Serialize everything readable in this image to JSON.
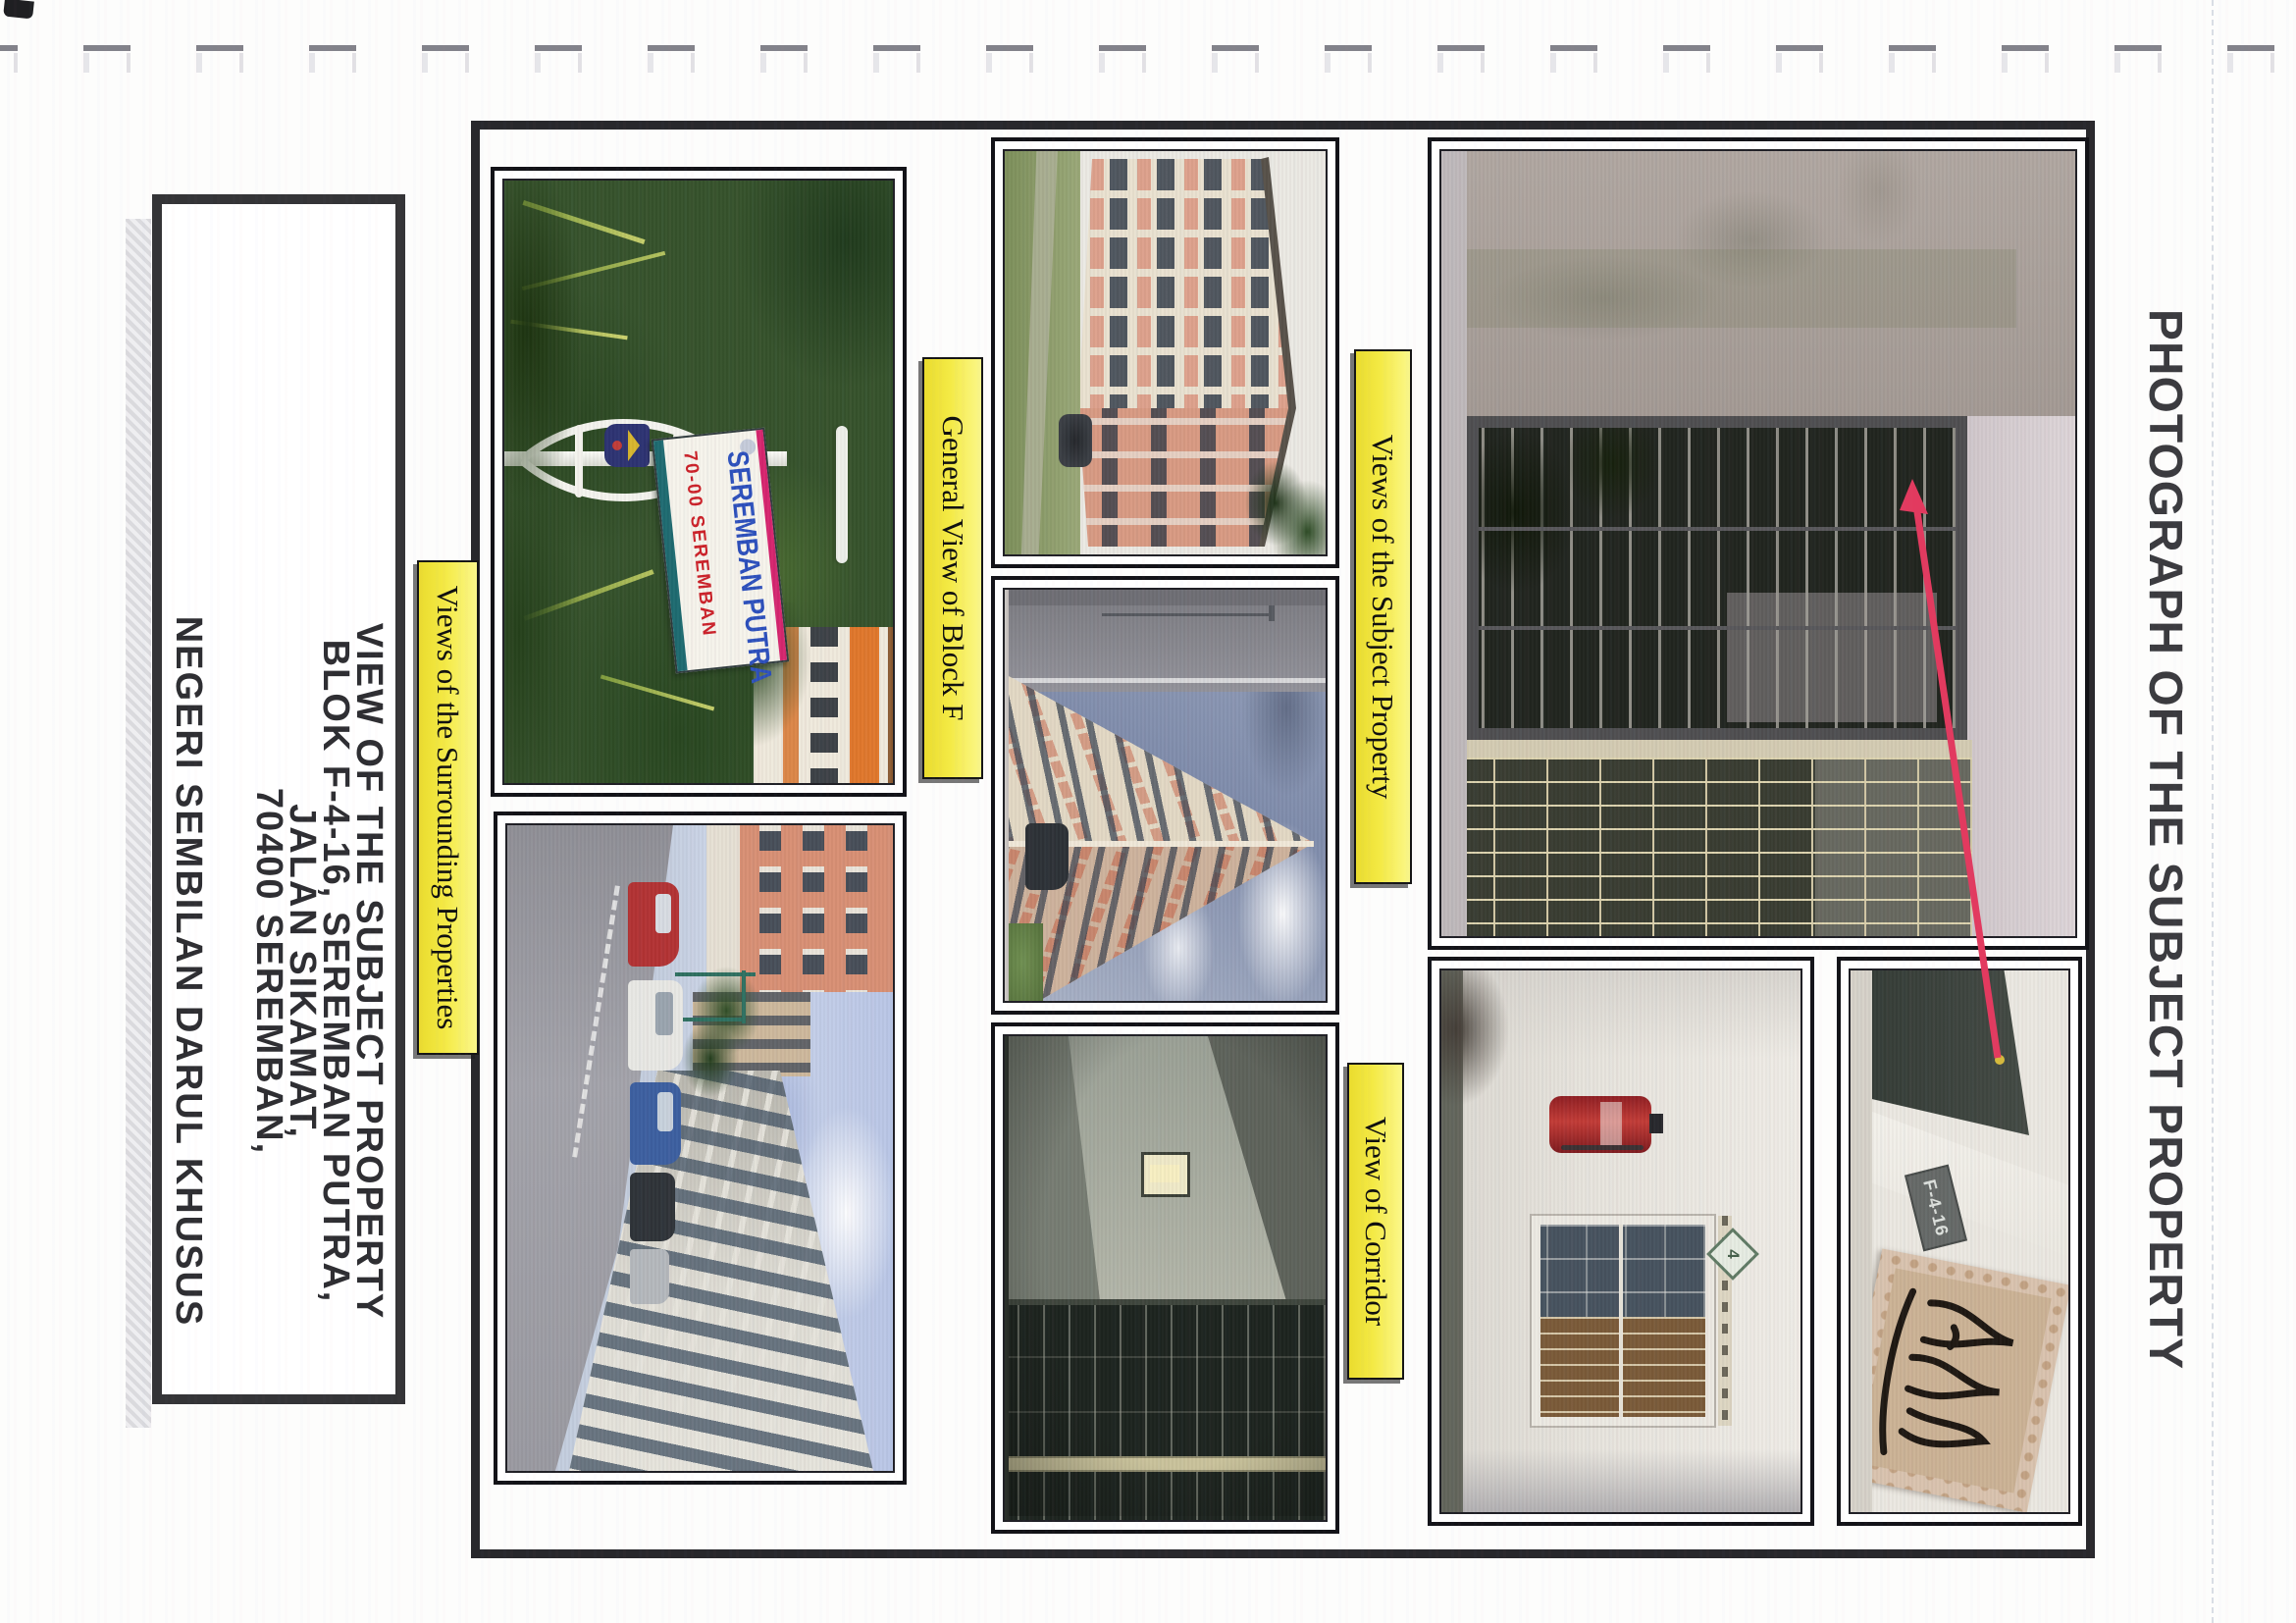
{
  "page": {
    "header": "PHOTOGRAPH OF THE SUBJECT PROPERTY"
  },
  "labels": {
    "subject": "Views of the Subject Property",
    "corridor": "View of Corridor",
    "block_f": "General View of Block F",
    "surrounding": "Views of the Surrounding Properties"
  },
  "address_box": {
    "lines": [
      "VIEW OF THE SUBJECT PROPERTY",
      "BLOK F-4-16, SEREMBAN PUTRA,",
      "JALAN SIKAMAT,",
      "70400 SEREMBAN,",
      "NEGERI SEMBILAN DARUL KHUSUS"
    ]
  },
  "photo_texts": {
    "sign_title": "SEREMBAN PUTRA",
    "sign_subtitle": "70-00 SEREMBAN",
    "unit_plate": "F-4-16",
    "floor_sign": "4"
  },
  "colors": {
    "label_yellow": "#f4e93d",
    "arrow_red": "#e23a5f",
    "sign_blue": "#2c50bd",
    "sign_red": "#cc2028",
    "paper": "#fdfdfc"
  }
}
